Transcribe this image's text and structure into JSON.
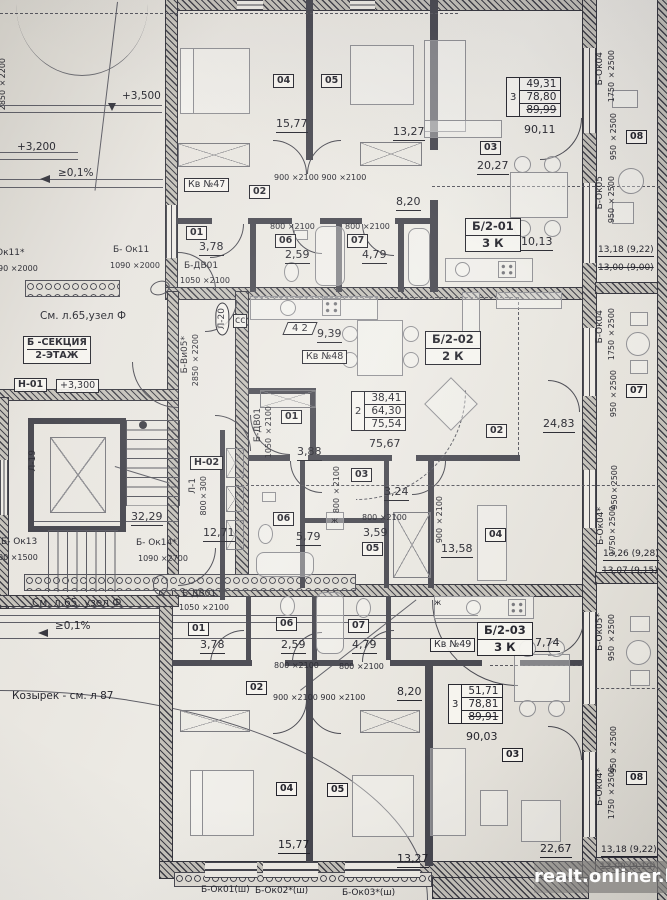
{
  "watermark": "realt.onliner.by",
  "site": {
    "elev_3500": "+3,500",
    "elev_3200": "+3,200",
    "slope_top": "≥0,1%",
    "slope_bottom": "≥0,1%",
    "canopy": "Козырек - см. л 87",
    "node_top": "См. л.65,узел Ф",
    "node_bottom": "См. л.65, узел Ф",
    "section": "Б -СЕКЦИЯ",
    "floor": "2-ЭТАЖ",
    "h01": "Н-01",
    "h01_elev": "+3,300",
    "h02": "Н-02",
    "l1": "Л-1",
    "l1_size": "800×300",
    "l19": "Л-19",
    "l20": "Л-20",
    "stairs_area": "32,29",
    "corridor_area": "12,71",
    "dim_2850_top": "2850 ×2200",
    "cc": "сс"
  },
  "windows": {
    "ok11_cut": "Ок11*",
    "ok11_cut_size": "90 ×2000",
    "ok11": "Б- Ок11",
    "ok11_size": "1090 ×2000",
    "ok13": "Б- Ок13",
    "ok13_size": "00 ×1500",
    "ok14": "Б- Ок14*",
    "ok14_size": "1090 ×2700",
    "vi05": "Б-Ви05*",
    "vi05_size": "2850 ×2200",
    "ok01": "Б-Ок01(ш)",
    "ok02": "Б-Ок02*(ш)",
    "ok03": "Б-Ок03*(ш)"
  },
  "right_side": {
    "top": {
      "name": "Б-Ок04",
      "size1": "1750 ×2500",
      "size2": "950 ×2500",
      "balcony_id": "08",
      "name2": "Б-Ок05",
      "size3": "950 ×2500",
      "dim": "13,18 (9,22)",
      "dim_prev": "13,00 (9,00)"
    },
    "mid": {
      "name": "Б-Ок04",
      "size1": "1750 ×2500",
      "size2": "950 ×2500",
      "balcony_id": "07",
      "size3": "950×2500",
      "name2": "Б-Ок04*",
      "size4": "1750×2500",
      "dim": "13,26 (9,28)",
      "dim_prev": "13,07 (9,15)"
    },
    "bottom": {
      "name": "Б-Ок05*",
      "size1": "950 ×2500",
      "size2": "950 ×2500",
      "name2": "Б-Ок04*",
      "size3": "1750 ×2500",
      "balcony_id": "08",
      "dim": "13,18 (9,22)",
      "dim_prev": "13,00 (9,19)"
    }
  },
  "flat47": {
    "kv": "Кв №47",
    "unit": "Б/2-01",
    "unit_rooms": "3 К",
    "table": {
      "n": "3",
      "r1": "49,31",
      "r2": "78,80",
      "r3": "89,99",
      "total": "90,11"
    },
    "r04": "04",
    "a04": "15,77",
    "r05": "05",
    "a05": "13,27",
    "r02": "02",
    "a02": "8,20",
    "r01": "01",
    "a01": "3,78",
    "r06": "06",
    "a06": "2,59",
    "r07": "07",
    "a07": "4,79",
    "r03": "03",
    "a03": "20,27",
    "kitchen": "10,13",
    "d900": "900 ×2100 900 ×2100",
    "d800a": "800 ×2100",
    "d800b": "800 ×2100",
    "door": "Б-ДВ01",
    "door_size": "1050 ×2100"
  },
  "flat48": {
    "kv": "Кв №48",
    "unit": "Б/2-02",
    "unit_rooms": "2 К",
    "marker": "4 2",
    "kitchen": "9,39",
    "table": {
      "n": "2",
      "r1": "38,41",
      "r2": "64,30",
      "r3": "75,54",
      "total": "75,67"
    },
    "r01": "01",
    "a01": "3,88",
    "r02": "02",
    "a02": "24,83",
    "r03": "03",
    "a03": "3,24",
    "r06": "06",
    "a06": "5,79",
    "r05": "05",
    "a05": "3,59",
    "r04": "04",
    "a04": "13,58",
    "door": "Б-ДВ01",
    "door_size": "1050 ×2100",
    "d800v": "800 ×2100",
    "d900v": "900 ×2100",
    "d800k": "800 ×2100",
    "washer": "ж"
  },
  "flat49": {
    "kv": "Кв №49",
    "unit": "Б/2-03",
    "unit_rooms": "3 К",
    "kitchen": "7,74",
    "table": {
      "n": "3",
      "r1": "51,71",
      "r2": "78,81",
      "r3": "89,91",
      "total": "90,03"
    },
    "r01": "01",
    "a01": "3,78",
    "r06": "06",
    "a06": "2,59",
    "r07": "07",
    "a07": "4,79",
    "r02": "02",
    "a02": "8,20",
    "r04": "04",
    "a04": "15,77",
    "r05": "05",
    "a05": "13,27",
    "r03": "03",
    "a03": "22,67",
    "door": "Б-ДВ01",
    "door_size": "1050 ×2100",
    "d800a": "800 ×2100",
    "d800b": "800 ×2100",
    "d900": "900 ×2100 900 ×2100",
    "washer": "ж"
  }
}
